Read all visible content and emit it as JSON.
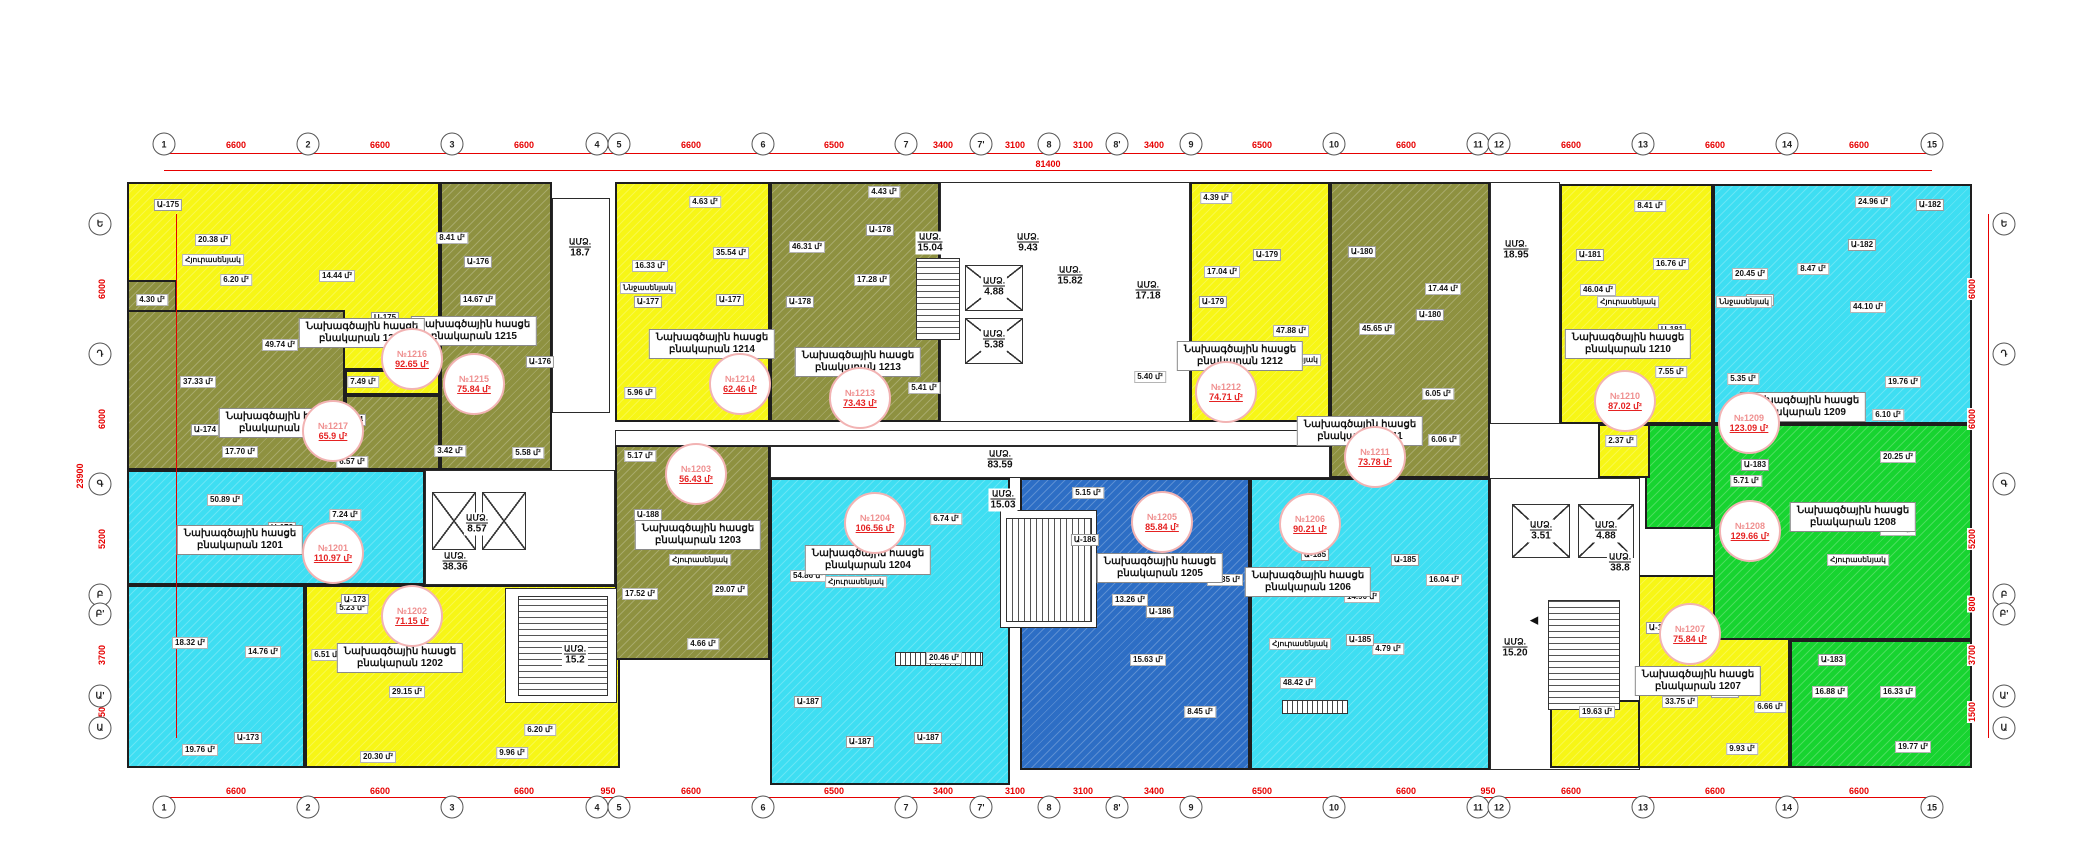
{
  "title": "Բնակելի շենքի հատակագիծ",
  "colors": {
    "yellow": "#f7f616",
    "olive": "#8e9140",
    "cyan": "#3edef2",
    "blue": "#2d6ec5",
    "green": "#17d430",
    "dim_red": "#e60000",
    "stamp_red": "#e52222"
  },
  "labels": {
    "address": "Նախագծային հասցե",
    "apt_prefix": "բնակարան",
    "core": "ԱՄՁ.",
    "sqm": "մ²"
  },
  "grid": {
    "top_total": "81400",
    "left_total": "23900",
    "cols": [
      [
        "1",
        164
      ],
      [
        "2",
        308
      ],
      [
        "3",
        452
      ],
      [
        "4",
        597
      ],
      [
        "5",
        619
      ],
      [
        "6",
        763
      ],
      [
        "7",
        906
      ],
      [
        "7'",
        981
      ],
      [
        "8",
        1049
      ],
      [
        "8'",
        1117
      ],
      [
        "9",
        1191
      ],
      [
        "10",
        1334
      ],
      [
        "11",
        1478
      ],
      [
        "12",
        1499
      ],
      [
        "13",
        1643
      ],
      [
        "14",
        1787
      ],
      [
        "15",
        1932
      ]
    ],
    "col_dims": [
      [
        "6600",
        236
      ],
      [
        "6600",
        380
      ],
      [
        "6600",
        524
      ],
      [
        "950",
        608
      ],
      [
        "6600",
        691
      ],
      [
        "6500",
        834
      ],
      [
        "3400",
        943
      ],
      [
        "3100",
        1015
      ],
      [
        "3100",
        1083
      ],
      [
        "3400",
        1154
      ],
      [
        "6500",
        1262
      ],
      [
        "6600",
        1406
      ],
      [
        "950",
        1488
      ],
      [
        "6600",
        1571
      ],
      [
        "6600",
        1715
      ],
      [
        "6600",
        1859
      ]
    ],
    "rows": [
      [
        "Ե",
        224
      ],
      [
        "Դ",
        354
      ],
      [
        "Գ",
        484
      ],
      [
        "Բ",
        595
      ],
      [
        "Բ'",
        614
      ],
      [
        "Ա'",
        696
      ],
      [
        "Ա",
        728
      ]
    ],
    "row_dims": [
      [
        "6000",
        289
      ],
      [
        "6000",
        419
      ],
      [
        "5200",
        539
      ],
      [
        "800",
        604
      ],
      [
        "3700",
        655
      ],
      [
        "1500",
        712
      ]
    ]
  },
  "apartments": [
    {
      "num": "1201",
      "color": "cyan",
      "stamp": "№1201",
      "area": "110.97 մ²",
      "label_xy": [
        240,
        540
      ],
      "stamp_xy": [
        333,
        553
      ],
      "blocks": [
        [
          127,
          470,
          298,
          115
        ],
        [
          127,
          585,
          178,
          183
        ]
      ],
      "rooms": [
        [
          "50.89 մ²",
          225,
          500
        ],
        [
          "7.24 մ²",
          345,
          515
        ],
        [
          "18.32 մ²",
          190,
          643
        ],
        [
          "14.76 մ²",
          263,
          652
        ],
        [
          "19.76 մ²",
          200,
          750
        ]
      ]
    },
    {
      "num": "1202",
      "color": "yellow",
      "stamp": "№1202",
      "area": "71.15 մ²",
      "label_xy": [
        400,
        658
      ],
      "stamp_xy": [
        412,
        616
      ],
      "blocks": [
        [
          305,
          585,
          315,
          183
        ]
      ],
      "rooms": [
        [
          "5.23 մ²",
          352,
          608
        ],
        [
          "6.51 մ²",
          327,
          655
        ],
        [
          "29.15 մ²",
          407,
          692
        ],
        [
          "6.20 մ²",
          540,
          730
        ],
        [
          "20.30 մ²",
          378,
          757
        ],
        [
          "9.96 մ²",
          512,
          753
        ]
      ]
    },
    {
      "num": "1203",
      "color": "olive",
      "stamp": "№1203",
      "area": "56.43 մ²",
      "label_xy": [
        698,
        535
      ],
      "stamp_xy": [
        696,
        474
      ],
      "blocks": [
        [
          615,
          445,
          155,
          215
        ]
      ],
      "rooms": [
        [
          "5.17 մ²",
          640,
          456
        ],
        [
          "17.52 մ²",
          640,
          594
        ],
        [
          "29.07 մ²",
          730,
          590
        ],
        [
          "4.66 մ²",
          703,
          644
        ]
      ]
    },
    {
      "num": "1204",
      "color": "cyan",
      "stamp": "№1204",
      "area": "106.56 մ²",
      "label_xy": [
        868,
        560
      ],
      "stamp_xy": [
        875,
        523
      ],
      "blocks": [
        [
          770,
          478,
          240,
          307
        ]
      ],
      "rooms": [
        [
          "54.86 մ²",
          808,
          576
        ],
        [
          "6.74 մ²",
          946,
          519
        ],
        [
          "20.46 մ²",
          944,
          658
        ]
      ]
    },
    {
      "num": "1205",
      "color": "blue",
      "stamp": "№1205",
      "area": "85.84 մ²",
      "label_xy": [
        1160,
        568
      ],
      "stamp_xy": [
        1162,
        522
      ],
      "blocks": [
        [
          1020,
          478,
          230,
          292
        ]
      ],
      "rooms": [
        [
          "5.15 մ²",
          1088,
          493
        ],
        [
          "13.26 մ²",
          1130,
          600
        ],
        [
          "43.35 մ²",
          1225,
          580
        ],
        [
          "15.63 մ²",
          1148,
          660
        ],
        [
          "8.45 մ²",
          1200,
          712
        ]
      ]
    },
    {
      "num": "1206",
      "color": "cyan",
      "stamp": "№1206",
      "area": "90.21 մ²",
      "label_xy": [
        1308,
        582
      ],
      "stamp_xy": [
        1310,
        524
      ],
      "blocks": [
        [
          1250,
          478,
          240,
          292
        ],
        [
          1390,
          422,
          100,
          56
        ]
      ],
      "rooms": [
        [
          "14.90 մ²",
          1362,
          597
        ],
        [
          "16.04 մ²",
          1444,
          580
        ],
        [
          "48.42 մ²",
          1298,
          683
        ],
        [
          "4.79 մ²",
          1388,
          649
        ],
        [
          "6.06 մ²",
          1444,
          440
        ]
      ]
    },
    {
      "num": "1207",
      "color": "yellow",
      "stamp": "№1207",
      "area": "75.84 մ²",
      "label_xy": [
        1698,
        681
      ],
      "stamp_xy": [
        1690,
        634
      ],
      "blocks": [
        [
          1637,
          575,
          153,
          193
        ]
      ],
      "top_blocks": [
        [
          1550,
          700,
          90,
          68
        ]
      ],
      "rooms": [
        [
          "33.75 մ²",
          1680,
          702
        ],
        [
          "6.66 մ²",
          1770,
          707
        ],
        [
          "9.93 մ²",
          1742,
          749
        ],
        [
          "19.63 մ²",
          1597,
          712
        ]
      ]
    },
    {
      "num": "1208",
      "color": "green",
      "stamp": "№1208",
      "area": "129.66 մ²",
      "label_xy": [
        1853,
        517
      ],
      "stamp_xy": [
        1750,
        531
      ],
      "blocks": [
        [
          1713,
          424,
          259,
          216
        ],
        [
          1645,
          424,
          68,
          105
        ],
        [
          1790,
          640,
          182,
          128
        ]
      ],
      "rooms": [
        [
          "20.25 մ²",
          1898,
          457
        ],
        [
          "48.72 մ²",
          1898,
          530
        ],
        [
          "5.71 մ²",
          1746,
          481
        ],
        [
          "16.88 մ²",
          1830,
          692
        ],
        [
          "16.33 մ²",
          1898,
          692
        ],
        [
          "19.77 մ²",
          1913,
          747
        ]
      ]
    },
    {
      "num": "1209",
      "color": "cyan",
      "stamp": "№1209",
      "area": "123.09 մ²",
      "label_xy": [
        1803,
        407
      ],
      "stamp_xy": [
        1749,
        423
      ],
      "blocks": [
        [
          1713,
          184,
          259,
          240
        ]
      ],
      "rooms": [
        [
          "24.96 մ²",
          1873,
          202
        ],
        [
          "20.45 մ²",
          1750,
          274
        ],
        [
          "8.47 մ²",
          1813,
          269
        ],
        [
          "44.10 մ²",
          1868,
          307
        ],
        [
          "5.35 մ²",
          1743,
          379
        ],
        [
          "19.76 մ²",
          1903,
          382
        ],
        [
          "6.10 մ²",
          1888,
          415
        ]
      ]
    },
    {
      "num": "1210",
      "color": "yellow",
      "stamp": "№1210",
      "area": "87.02 մ²",
      "label_xy": [
        1628,
        344
      ],
      "stamp_xy": [
        1625,
        401
      ],
      "blocks": [
        [
          1560,
          184,
          153,
          240
        ],
        [
          1598,
          424,
          52,
          54
        ]
      ],
      "rooms": [
        [
          "8.41 մ²",
          1650,
          206
        ],
        [
          "16.76 մ²",
          1671,
          264
        ],
        [
          "46.04 մ²",
          1598,
          290
        ],
        [
          "7.55 մ²",
          1671,
          372
        ],
        [
          "2.37 մ²",
          1621,
          441
        ]
      ]
    },
    {
      "num": "1211",
      "color": "olive",
      "stamp": "№1211",
      "area": "73.78 մ²",
      "label_xy": [
        1360,
        431
      ],
      "stamp_xy": [
        1375,
        457
      ],
      "blocks": [
        [
          1330,
          182,
          160,
          296
        ]
      ],
      "rooms": [
        [
          "45.65 մ²",
          1377,
          329
        ],
        [
          "17.44 մ²",
          1443,
          289
        ],
        [
          "6.05 մ²",
          1438,
          394
        ]
      ]
    },
    {
      "num": "1212",
      "color": "yellow",
      "stamp": "№1212",
      "area": "74.71 մ²",
      "label_xy": [
        1240,
        356
      ],
      "stamp_xy": [
        1226,
        392
      ],
      "blocks": [
        [
          1190,
          182,
          140,
          240
        ],
        [
          1113,
          355,
          77,
          67
        ]
      ],
      "rooms": [
        [
          "4.39 մ²",
          1216,
          198
        ],
        [
          "17.04 մ²",
          1222,
          272
        ],
        [
          "47.88 մ²",
          1291,
          331
        ],
        [
          "5.40 մ²",
          1150,
          377
        ]
      ]
    },
    {
      "num": "1213",
      "color": "olive",
      "stamp": "№1213",
      "area": "73.43 մ²",
      "label_xy": [
        858,
        362
      ],
      "stamp_xy": [
        860,
        398
      ],
      "blocks": [
        [
          770,
          182,
          170,
          240
        ]
      ],
      "rooms": [
        [
          "46.31 մ²",
          807,
          247
        ],
        [
          "17.28 մ²",
          872,
          280
        ],
        [
          "4.43 մ²",
          884,
          192
        ],
        [
          "5.41 մ²",
          924,
          388
        ]
      ]
    },
    {
      "num": "1214",
      "color": "yellow",
      "stamp": "№1214",
      "area": "62.46 մ²",
      "label_xy": [
        712,
        344
      ],
      "stamp_xy": [
        740,
        384
      ],
      "blocks": [
        [
          615,
          182,
          155,
          240
        ]
      ],
      "rooms": [
        [
          "4.63 մ²",
          705,
          202
        ],
        [
          "16.33 մ²",
          650,
          266
        ],
        [
          "35.54 մ²",
          731,
          253
        ],
        [
          "5.96 մ²",
          640,
          393
        ]
      ]
    },
    {
      "num": "1215",
      "color": "olive",
      "stamp": "№1215",
      "area": "75.84 մ²",
      "label_xy": [
        474,
        331
      ],
      "stamp_xy": [
        474,
        384
      ],
      "blocks": [
        [
          440,
          182,
          112,
          288
        ],
        [
          345,
          395,
          95,
          75
        ]
      ],
      "rooms": [
        [
          "8.41 մ²",
          452,
          238
        ],
        [
          "14.67 մ²",
          478,
          300
        ],
        [
          "44.76 մ²",
          510,
          338
        ],
        [
          "3.42 մ²",
          450,
          451
        ],
        [
          "5.58 մ²",
          528,
          453
        ]
      ]
    },
    {
      "num": "1216",
      "color": "yellow",
      "stamp": "№1216",
      "area": "92.65 մ²",
      "label_xy": [
        362,
        333
      ],
      "stamp_xy": [
        412,
        359
      ],
      "blocks": [
        [
          127,
          182,
          313,
          188
        ],
        [
          345,
          370,
          95,
          25
        ]
      ],
      "rooms": [
        [
          "20.38 մ²",
          213,
          240
        ],
        [
          "6.20 մ²",
          236,
          280
        ],
        [
          "14.44 մ²",
          337,
          276
        ],
        [
          "7.49 մ²",
          363,
          382
        ]
      ]
    },
    {
      "num": "1217",
      "color": "olive",
      "stamp": "№1217",
      "area": "65.9 մ²",
      "label_xy": [
        282,
        423
      ],
      "stamp_xy": [
        333,
        431
      ],
      "blocks": [
        [
          127,
          310,
          218,
          160
        ],
        [
          127,
          280,
          50,
          32
        ]
      ],
      "rooms": [
        [
          "37.33 մ²",
          198,
          382
        ],
        [
          "49.74 մ²",
          280,
          345
        ],
        [
          "17.70 մ²",
          240,
          452
        ],
        [
          "6.57 մ²",
          352,
          462
        ],
        [
          "4.30 մ²",
          152,
          300
        ]
      ]
    }
  ],
  "white_rects": [
    [
      552,
      198,
      58,
      215
    ],
    [
      940,
      182,
      250,
      240
    ],
    [
      425,
      470,
      190,
      115
    ],
    [
      505,
      588,
      112,
      115
    ],
    [
      1490,
      182,
      70,
      242
    ],
    [
      1490,
      478,
      150,
      292
    ],
    [
      615,
      430,
      715,
      16
    ],
    [
      770,
      446,
      560,
      32
    ],
    [
      1000,
      510,
      97,
      118
    ]
  ],
  "stairs": [
    [
      916,
      258,
      44,
      82,
      "h"
    ],
    [
      518,
      596,
      90,
      100,
      "h"
    ],
    [
      1548,
      600,
      72,
      110,
      "h"
    ],
    [
      1006,
      518,
      86,
      104,
      "v"
    ]
  ],
  "elevators": [
    [
      965,
      265,
      58,
      46
    ],
    [
      965,
      318,
      58,
      46
    ],
    [
      432,
      492,
      44,
      58
    ],
    [
      482,
      492,
      44,
      58
    ],
    [
      1512,
      504,
      58,
      54
    ],
    [
      1578,
      504,
      56,
      54
    ]
  ],
  "entry_steps": [
    [
      895,
      652,
      88,
      14
    ],
    [
      1282,
      700,
      66,
      14
    ]
  ],
  "arrows": [
    [
      "▲",
      925,
      250
    ],
    [
      "◀",
      1534,
      620
    ]
  ],
  "core_labels": [
    [
      "18.7",
      580,
      248
    ],
    [
      "8.57",
      477,
      524
    ],
    [
      "38.36",
      455,
      562
    ],
    [
      "15.2",
      575,
      655
    ],
    [
      "15.04",
      930,
      243
    ],
    [
      "9.43",
      1028,
      243
    ],
    [
      "4.88",
      994,
      287
    ],
    [
      "5.38",
      994,
      340
    ],
    [
      "15.82",
      1070,
      276
    ],
    [
      "17.18",
      1148,
      291
    ],
    [
      "83.59",
      1000,
      460
    ],
    [
      "15.03",
      1003,
      500
    ],
    [
      "18.95",
      1516,
      250
    ],
    [
      "3.51",
      1541,
      531
    ],
    [
      "4.88",
      1606,
      531
    ],
    [
      "38.8",
      1620,
      563
    ],
    [
      "15.20",
      1515,
      648
    ]
  ],
  "callouts": [
    [
      "Ա-173",
      282,
      528
    ],
    [
      "Ա-173",
      248,
      738
    ],
    [
      "Ա-173",
      355,
      600
    ],
    [
      "Ա-174",
      205,
      430
    ],
    [
      "Ա-174",
      352,
      420
    ],
    [
      "Ա-175",
      168,
      205
    ],
    [
      "Ա-175",
      385,
      318
    ],
    [
      "Ա-176",
      478,
      262
    ],
    [
      "Ա-176",
      540,
      362
    ],
    [
      "Ա-177",
      648,
      302
    ],
    [
      "Ա-177",
      730,
      300
    ],
    [
      "Ա-178",
      800,
      302
    ],
    [
      "Ա-178",
      880,
      230
    ],
    [
      "Ա-179",
      1213,
      302
    ],
    [
      "Ա-179",
      1267,
      255
    ],
    [
      "Ա-180",
      1362,
      252
    ],
    [
      "Ա-180",
      1430,
      315
    ],
    [
      "Ա-181",
      1590,
      255
    ],
    [
      "Ա-181",
      1672,
      330
    ],
    [
      "Ա-182",
      1760,
      300
    ],
    [
      "Ա-182",
      1862,
      245
    ],
    [
      "Ա-182",
      1930,
      205
    ],
    [
      "Ա-183",
      1755,
      465
    ],
    [
      "Ա-183",
      1832,
      660
    ],
    [
      "Ա-184",
      1660,
      628
    ],
    [
      "Ա-184",
      1725,
      692
    ],
    [
      "Ա-185",
      1315,
      555
    ],
    [
      "Ա-185",
      1405,
      560
    ],
    [
      "Ա-185",
      1360,
      640
    ],
    [
      "Ա-186",
      1085,
      540
    ],
    [
      "Ա-186",
      1160,
      612
    ],
    [
      "Ա-187",
      808,
      702
    ],
    [
      "Ա-187",
      860,
      742
    ],
    [
      "Ա-187",
      928,
      738
    ],
    [
      "Ա-188",
      648,
      515
    ]
  ],
  "room_names": [
    [
      "Հյուրասենյակ",
      213,
      260
    ],
    [
      "Հյուրասենյակ",
      232,
      548
    ],
    [
      "Հյուրասենյակ",
      700,
      560
    ],
    [
      "Հյուրասենյակ",
      856,
      582
    ],
    [
      "Հյուրասենյակ",
      1300,
      644
    ],
    [
      "Հյուրասենյակ",
      1858,
      560
    ],
    [
      "Հյուրասենյակ",
      1628,
      302
    ],
    [
      "Հյուրասենյակ",
      1290,
      360
    ],
    [
      "Ննջասենյակ",
      648,
      288
    ],
    [
      "Ննջասենյակ",
      1744,
      302
    ]
  ],
  "dim_lines": {
    "top_y": 153,
    "top_total_y": 170,
    "top_total_xy": [
      1048,
      164
    ],
    "bottom_y": 797,
    "bottom_bubble_y": 807,
    "bottom_text_y": 791,
    "left_x": 176,
    "left_text_x": 102,
    "left_bubble_x": 100,
    "left_total_xy": [
      80,
      476
    ],
    "right_x": 1988,
    "right_text_x": 1972,
    "right_bubble_x": 2004,
    "top_bubble_y": 144,
    "top_text_y": 145
  }
}
